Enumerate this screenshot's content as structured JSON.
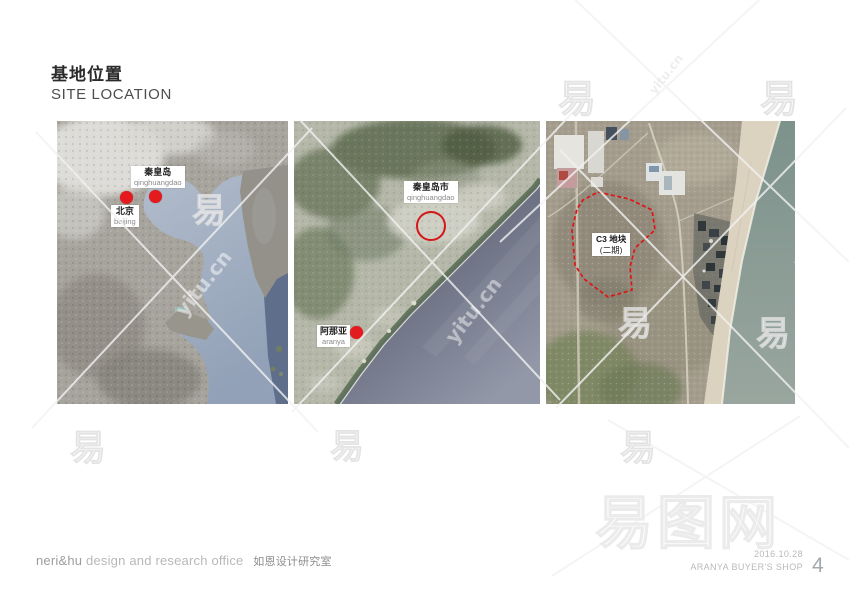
{
  "header": {
    "title_zh": "基地位置",
    "title_en": "SITE LOCATION"
  },
  "maps": {
    "regional": {
      "description": "satellite map of Bohai Sea region",
      "markers": [
        {
          "zh": "秦皇岛",
          "en": "qinghuangdao"
        },
        {
          "zh": "北京",
          "en": "beijing"
        }
      ]
    },
    "city": {
      "description": "satellite map of Qinhuangdao coastline",
      "markers": [
        {
          "zh": "秦皇岛市",
          "en": "qinghuangdao"
        },
        {
          "zh": "阿那亚",
          "en": "aranya"
        }
      ]
    },
    "site": {
      "description": "aerial view of Aranya site",
      "label_line1": "C3 地块",
      "label_line2": "(二期)"
    }
  },
  "footer": {
    "studio_name": "neri&hu",
    "studio_en": "design and research office",
    "studio_zh": "如恩设计研究室",
    "date": "2016.10.28",
    "project": "ARANYA BUYER'S SHOP",
    "page_number": "4"
  },
  "watermark": {
    "glyph": "易",
    "site": "yitu.cn",
    "big_text": "易图网"
  },
  "colors": {
    "marker_red": "#e41b1e",
    "boundary_red": "#e01414",
    "title_color": "#2b2b2b"
  }
}
